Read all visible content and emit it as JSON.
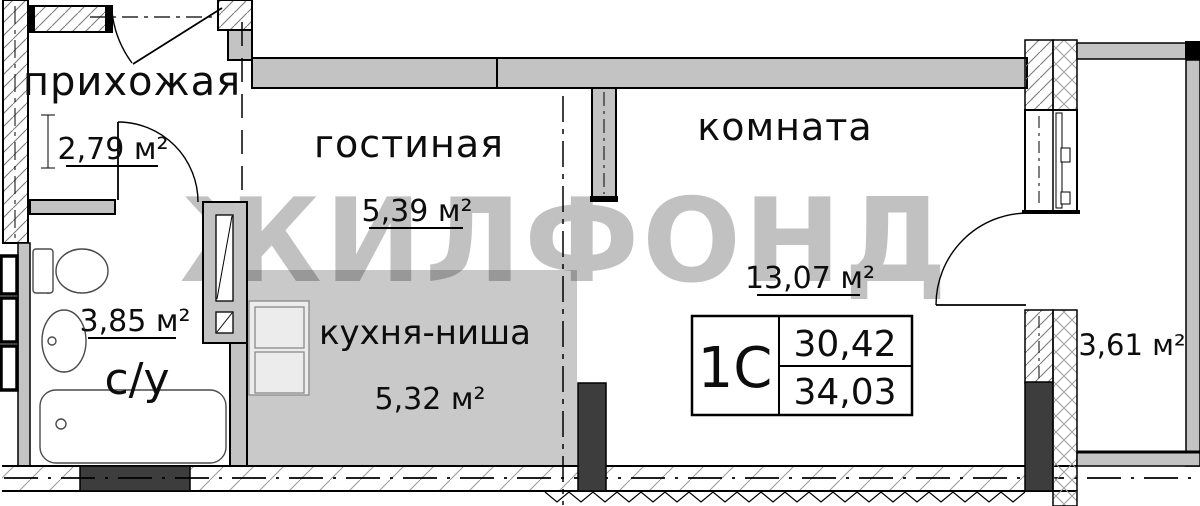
{
  "watermark": "ЖИЛФОНД",
  "rooms": {
    "hallway": {
      "label": "прихожая",
      "area": "2,79 м²"
    },
    "living": {
      "label": "гостиная",
      "area": "5,39 м²"
    },
    "room": {
      "label": "комната",
      "area": "13,07 м²"
    },
    "kitchen": {
      "label": "кухня-ниша",
      "area": "5,32 м²"
    },
    "bathroom": {
      "label": "с/у",
      "area": "3,85 м²"
    },
    "balcony": {
      "area": "3,61 м²"
    }
  },
  "info_box": {
    "plan_type": "1С",
    "upper_value": "30,42",
    "lower_value": "34,03"
  },
  "colors": {
    "wall_fill": "#c3c3c3",
    "kitchen_floor": "#c9c9c9",
    "dark_fill": "#3d3d3d",
    "watermark_gray": "#bdbdbd"
  }
}
